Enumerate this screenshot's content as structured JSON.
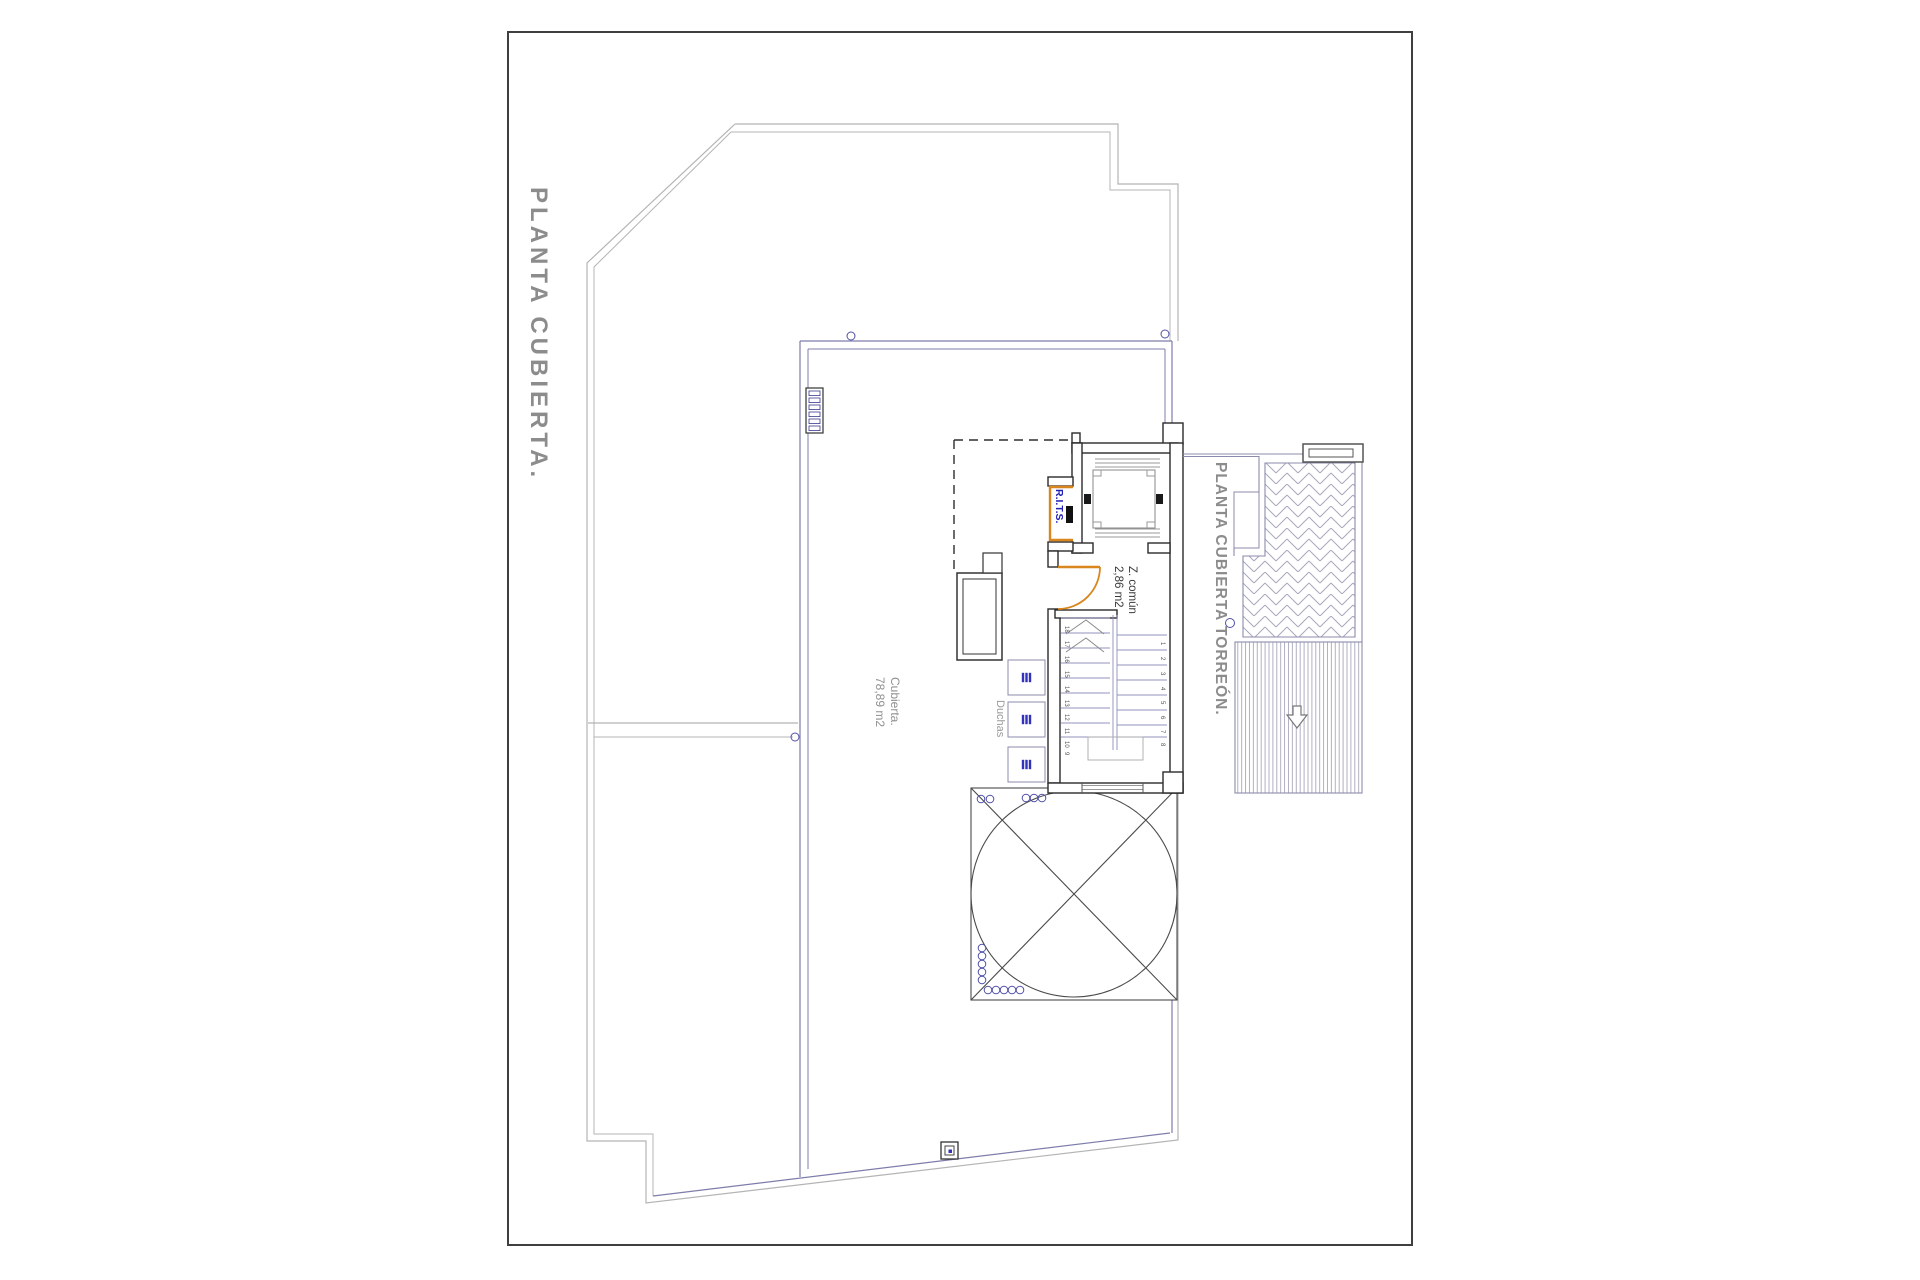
{
  "sheet": {
    "title": "PLANTA CUBIERTA.",
    "torreon_label": "PLANTA CUBIERTA TORREÓN."
  },
  "areas": {
    "cubierta": {
      "name": "Cubierta.",
      "size": "78,89 m2"
    },
    "z_comun": {
      "name": "Z. común",
      "size": "2,86 m2"
    },
    "duchas_label": "Duchas",
    "rits_label": "R.I.T.S."
  },
  "stairs": {
    "left": [
      "18",
      "17",
      "16",
      "15",
      "14",
      "13",
      "12",
      "11",
      "10",
      "9"
    ],
    "right": [
      "1",
      "2",
      "3",
      "4",
      "5",
      "6",
      "7",
      "8"
    ]
  },
  "colors": {
    "sheet_border": "#3f3f3f",
    "outline_gray": "#b4b4b4",
    "roof_line_blue": "#7d7dab",
    "wall_dark": "#2b2b2b",
    "accent_orange": "#d9861f",
    "rits_text_blue": "#2121b8",
    "label_gray": "#8c8c8c",
    "hatch_blue_gray": "#a8a8bd"
  }
}
